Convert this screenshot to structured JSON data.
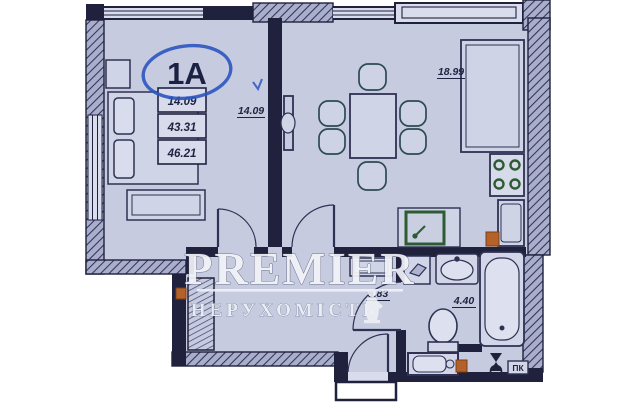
{
  "plan": {
    "unit_label": "1A",
    "area_table": {
      "rows": [
        "14.09",
        "43.31",
        "46.21"
      ]
    },
    "rooms": {
      "bedroom": {
        "name": "bedroom",
        "area": "14.09"
      },
      "kitchen_living": {
        "name": "kitchen-living",
        "area": "18.99"
      },
      "hallway": {
        "name": "hallway",
        "area": "5.83"
      },
      "bathroom": {
        "name": "bathroom",
        "area": "4.40"
      }
    },
    "labels": {
      "fire_hydrant": "ПК"
    },
    "fixtures": [
      "bed",
      "wardrobe",
      "dining-table",
      "chairs",
      "tv-panel",
      "kitchen-counter",
      "stove",
      "fridge",
      "kitchen-sink",
      "washbasin",
      "bathtub",
      "toilet",
      "washing-machine",
      "valve",
      "fire-hydrant-box"
    ],
    "colors": {
      "floor": "#c6cbe0",
      "wall": "#20213c",
      "pen_blue": "#2b55c0",
      "fixture_green": "#2d5c33",
      "marker_orange": "#b4622a",
      "watermark_white": "#f3f4f8"
    }
  },
  "watermark": {
    "line1": "PREMIER",
    "line2": "НЕРУХОМІСТЬ",
    "logo": "statue-icon"
  }
}
